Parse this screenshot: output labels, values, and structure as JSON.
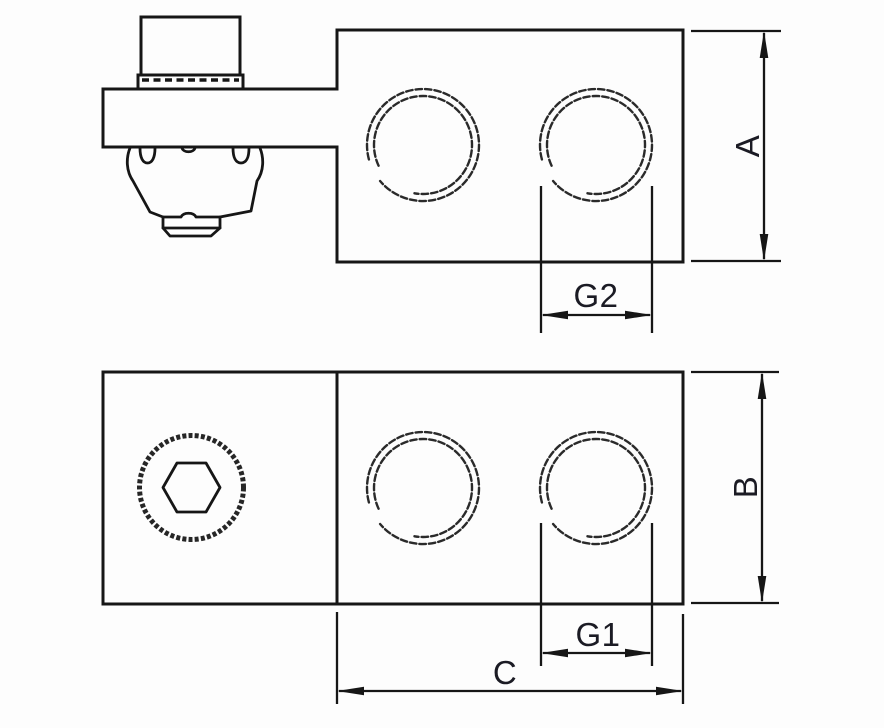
{
  "drawing": {
    "dimension_labels": {
      "A": "A",
      "B": "B",
      "C": "C",
      "G1": "G1",
      "G2": "G2"
    }
  },
  "colors": {
    "line": "#161616",
    "thread_arc": "#2a2a2a",
    "label_text": "#1b1b24",
    "background": "#fdfdfd"
  }
}
